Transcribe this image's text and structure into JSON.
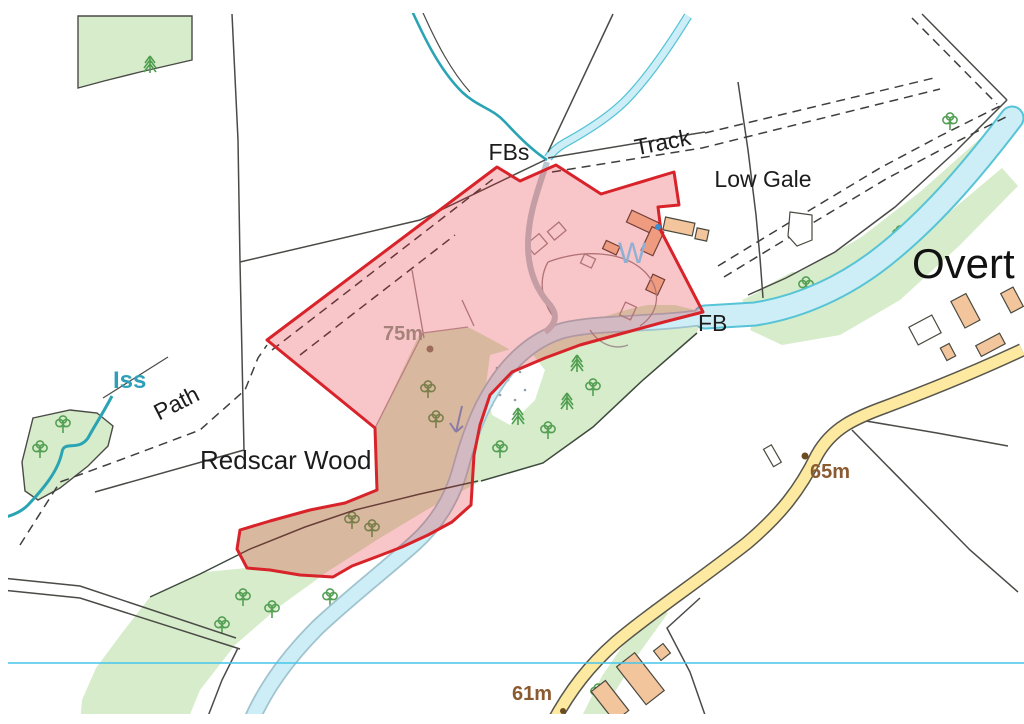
{
  "map": {
    "place_labels": {
      "fbs": "FBs",
      "track": "Track",
      "low_gale": "Low Gale",
      "overton_partial": "Overt",
      "iss": "Iss",
      "path": "Path",
      "redscar_wood": "Redscar Wood",
      "fb": "FB",
      "well": "W"
    },
    "spot_heights": [
      {
        "label": "75m"
      },
      {
        "label": "65m"
      },
      {
        "label": "61m"
      }
    ],
    "colors": {
      "parcel_boundary": "#d8232a",
      "parcel_fill": "#e4242c",
      "woodland": "#d6ecca",
      "water_fill": "#cdeef6",
      "water_edge": "#56c3d6",
      "stream": "#2aa4b4",
      "road_fill": "#fde99f",
      "road_casing": "#57564d",
      "building_fill": "#f3c59d",
      "grid_line": "#45c5ea",
      "spot_height_text": "#8a5a30",
      "spot_height_text_tinted": "#a5837a",
      "water_label": "#2d9fb8",
      "well_label": "#8fb0d4"
    }
  }
}
